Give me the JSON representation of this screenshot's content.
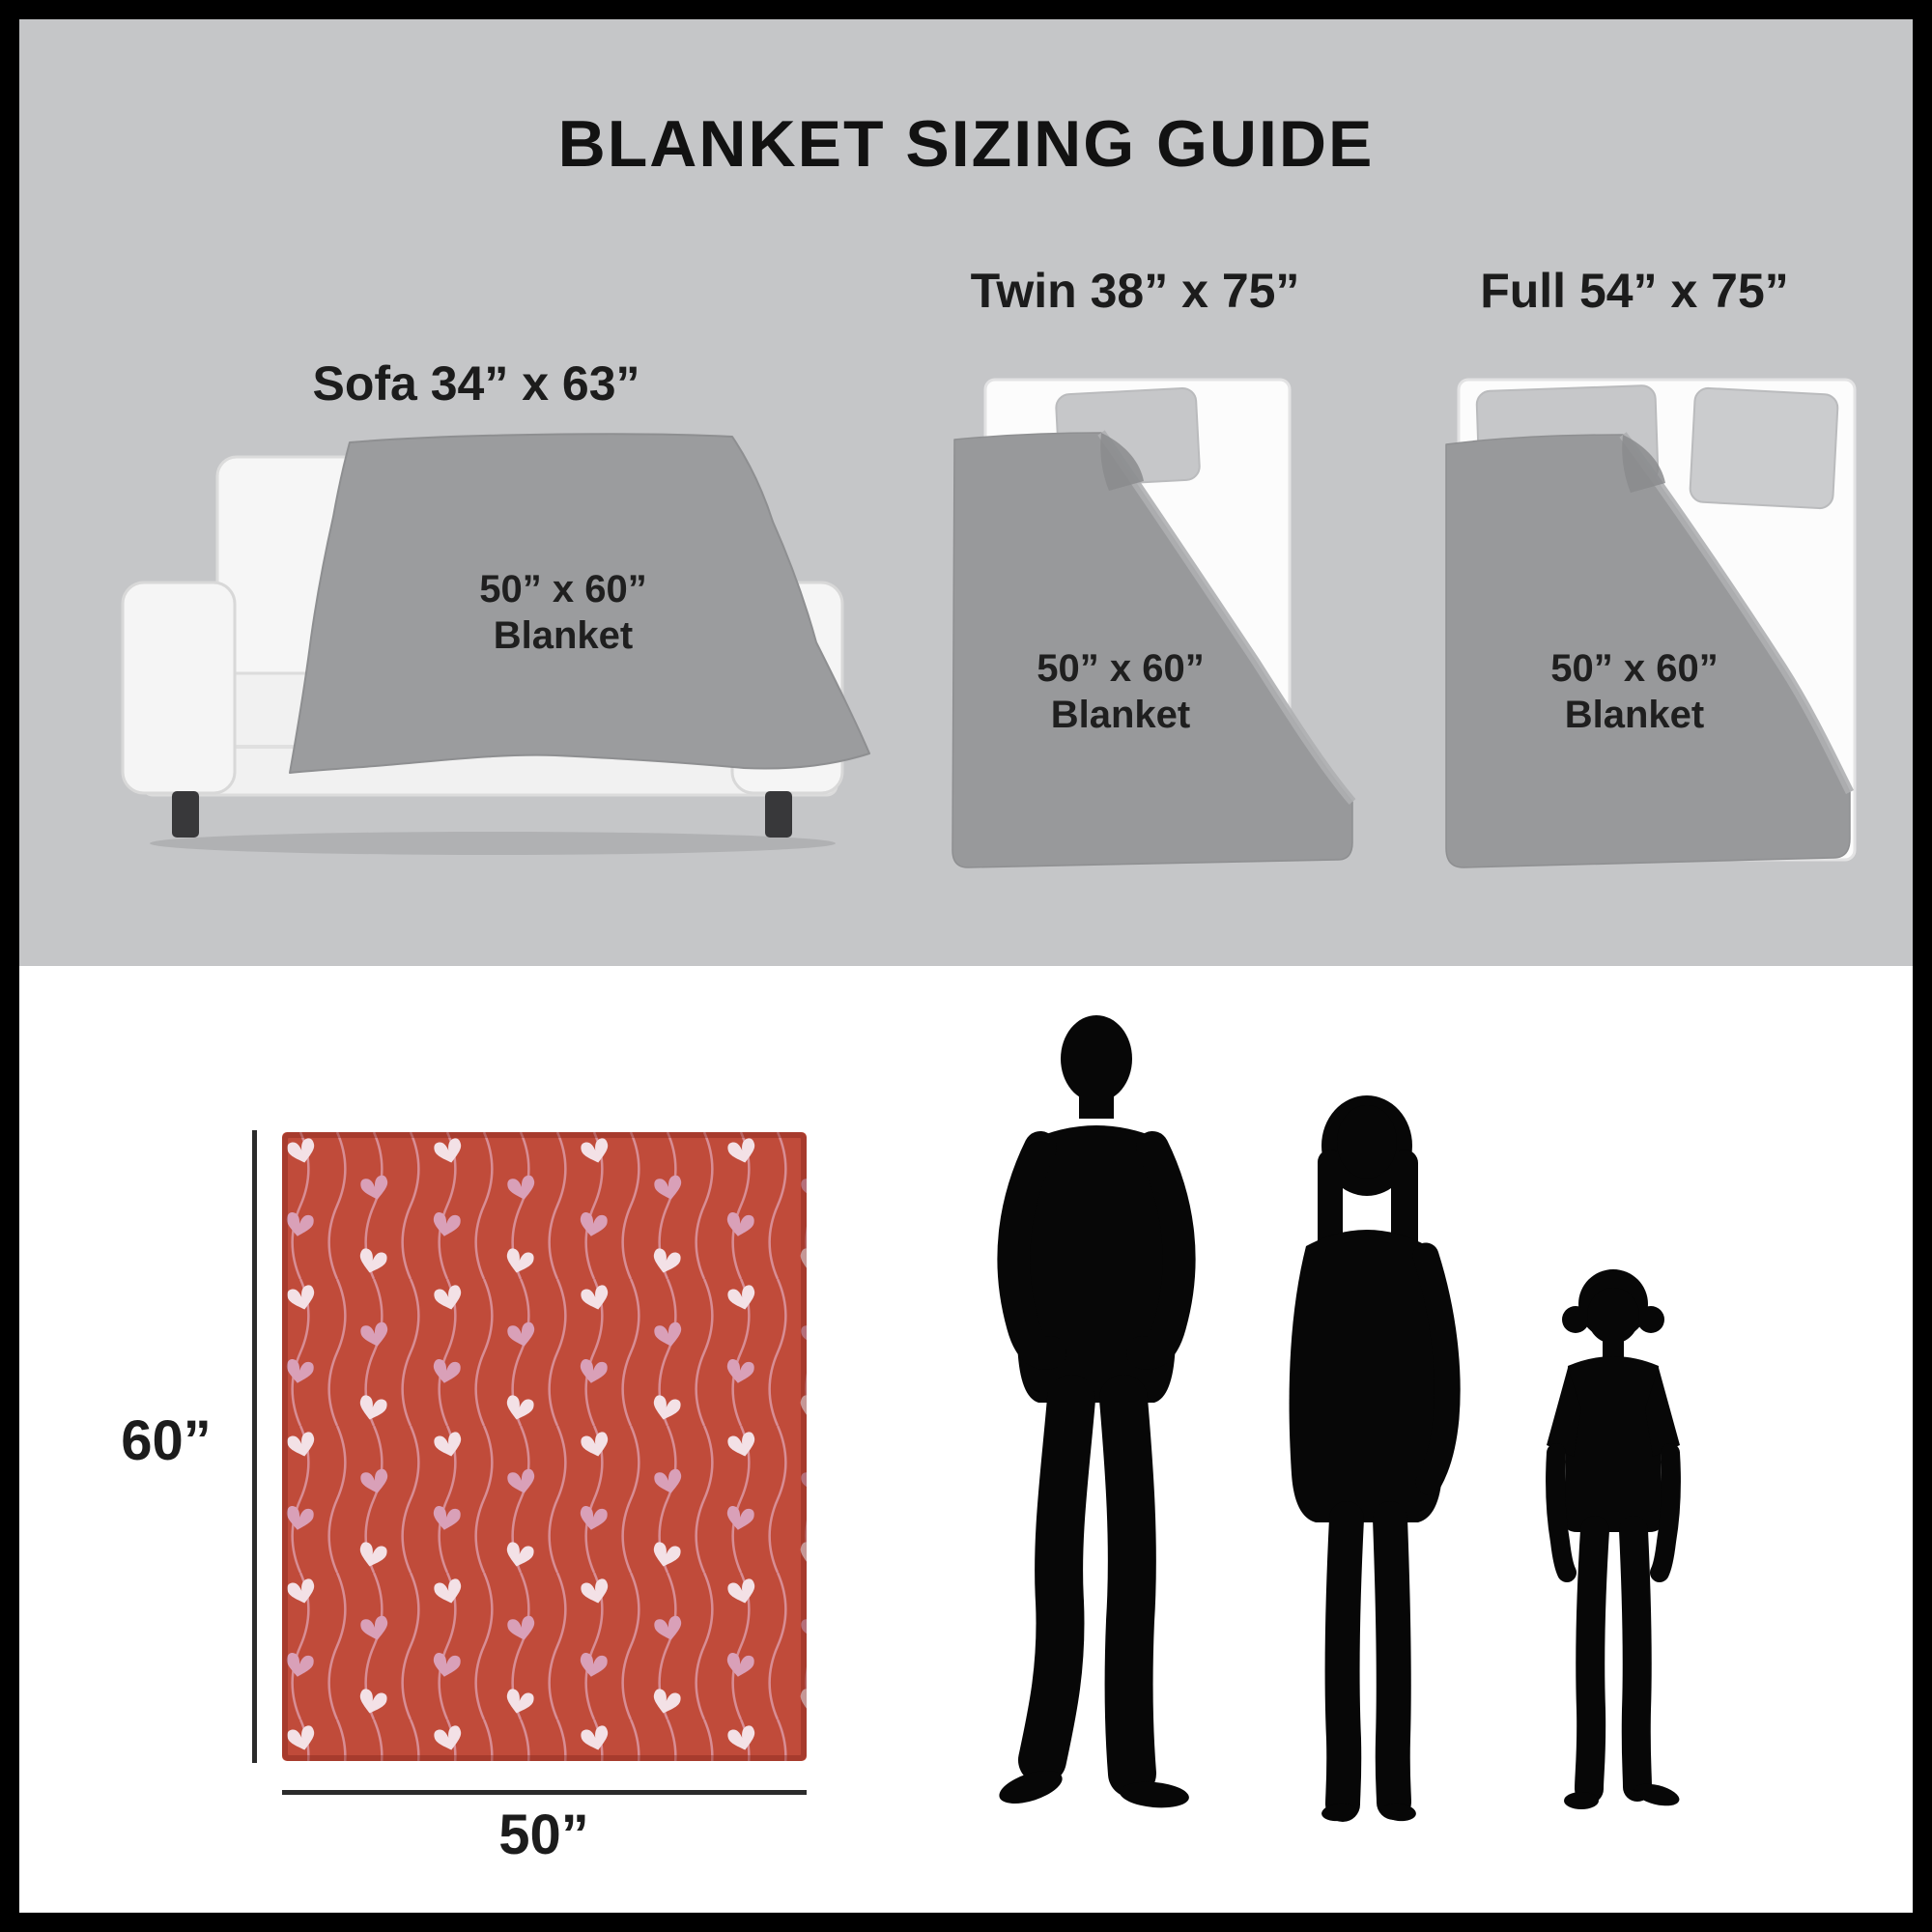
{
  "title": "BLANKET SIZING GUIDE",
  "sections": {
    "sofa": {
      "label": "Sofa 34” x 63”",
      "blanket_line1": "50” x 60”",
      "blanket_line2": "Blanket"
    },
    "twin": {
      "label": "Twin 38” x 75”",
      "blanket_line1": "50” x 60”",
      "blanket_line2": "Blanket"
    },
    "full": {
      "label": "Full 54” x 75”",
      "blanket_line1": "50” x 60”",
      "blanket_line2": "Blanket"
    }
  },
  "product_blanket": {
    "height_label": "60”",
    "width_label": "50”",
    "pattern": "hearts-on-wavy-stripes"
  },
  "colors": {
    "panel_gray": "#c5c6c8",
    "blanket_gray": "#98999b",
    "sofa_blanket_gray": "#9b9c9e",
    "blanket_red": "#c04b3a",
    "heart_pale": "#f3e1e6",
    "heart_rose": "#d9a0b8",
    "wave_pink": "#dc99a3",
    "silhouette_black": "#070707",
    "text_black": "#161616"
  }
}
